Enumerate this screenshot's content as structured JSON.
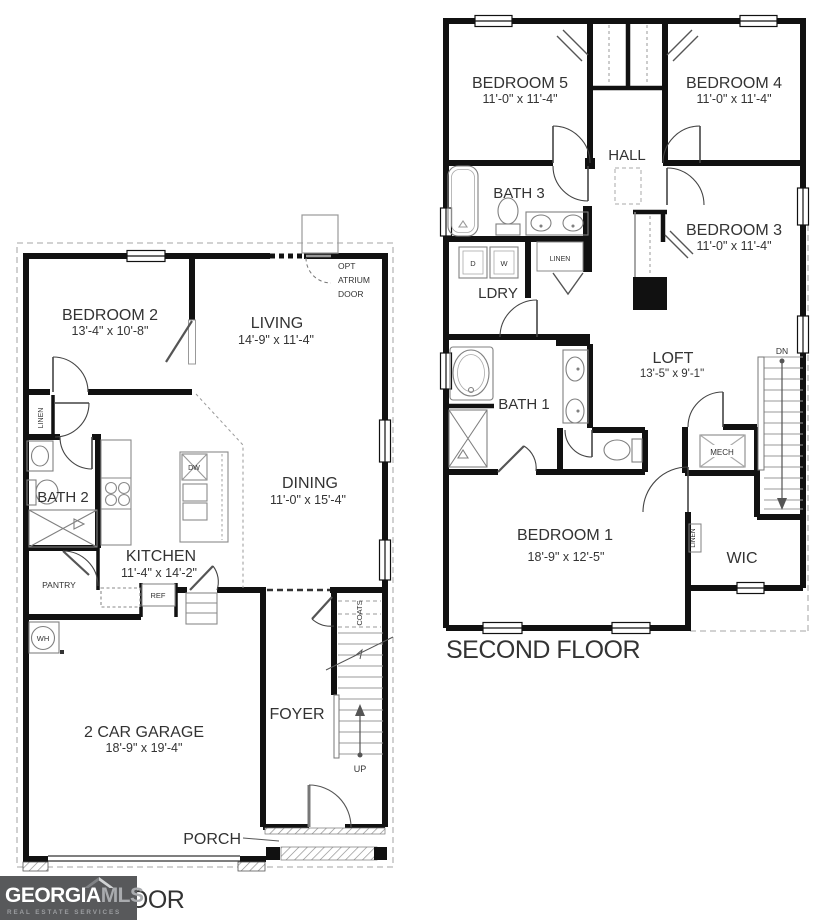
{
  "first_floor": {
    "floor_label": "FIRST FLOOR",
    "rooms": {
      "bedroom2": {
        "name": "BEDROOM 2",
        "dims": "13'-4\" x 10'-8\""
      },
      "living": {
        "name": "LIVING",
        "dims": "14'-9\" x 11'-4\""
      },
      "dining": {
        "name": "DINING",
        "dims": "11'-0\" x 15'-4\""
      },
      "kitchen": {
        "name": "KITCHEN",
        "dims": "11'-4\" x 14'-2\""
      },
      "bath2": {
        "name": "BATH 2"
      },
      "garage": {
        "name": "2 CAR GARAGE",
        "dims": "18'-9\" x 19'-4\""
      },
      "foyer": {
        "name": "FOYER"
      },
      "porch": {
        "name": "PORCH"
      },
      "pantry": {
        "name": "PANTRY"
      },
      "linen": {
        "name": "LINEN"
      },
      "coats": {
        "name": "COATS"
      }
    },
    "annotations": {
      "opt_door_line1": "OPT",
      "opt_door_line2": "ATRIUM",
      "opt_door_line3": "DOOR",
      "ref": "REF",
      "dw": "DW",
      "wh": "WH",
      "up": "UP"
    }
  },
  "second_floor": {
    "floor_label": "SECOND FLOOR",
    "rooms": {
      "bedroom5": {
        "name": "BEDROOM 5",
        "dims": "11'-0\" x 11'-4\""
      },
      "bedroom4": {
        "name": "BEDROOM 4",
        "dims": "11'-0\" x 11'-4\""
      },
      "bedroom3": {
        "name": "BEDROOM 3",
        "dims": "11'-0\" x 11'-4\""
      },
      "bedroom1": {
        "name": "BEDROOM 1",
        "dims": "18'-9\" x 12'-5\""
      },
      "hall": {
        "name": "HALL"
      },
      "bath3": {
        "name": "BATH 3"
      },
      "bath1": {
        "name": "BATH 1"
      },
      "laundry": {
        "name": "LDRY"
      },
      "loft": {
        "name": "LOFT",
        "dims": "13'-5\" x 9'-1\""
      },
      "wic": {
        "name": "WIC"
      },
      "mech": {
        "name": "MECH"
      },
      "linen_hall": {
        "name": "LINEN"
      },
      "linen_wic": {
        "name": "LINEN"
      }
    },
    "annotations": {
      "dryer": "D",
      "washer": "W",
      "dn": "DN"
    }
  },
  "logo": {
    "brand": "GEORGIA",
    "brand_suffix": "MLS",
    "tagline": "REAL ESTATE SERVICES"
  },
  "colors": {
    "wall": "#111111",
    "text": "#333333",
    "fixture": "#808080",
    "dashed_outline": "#b8b8b8",
    "logo_bg": "#58595b",
    "logo_text": "#ffffff",
    "logo_accent": "#a9abae"
  }
}
